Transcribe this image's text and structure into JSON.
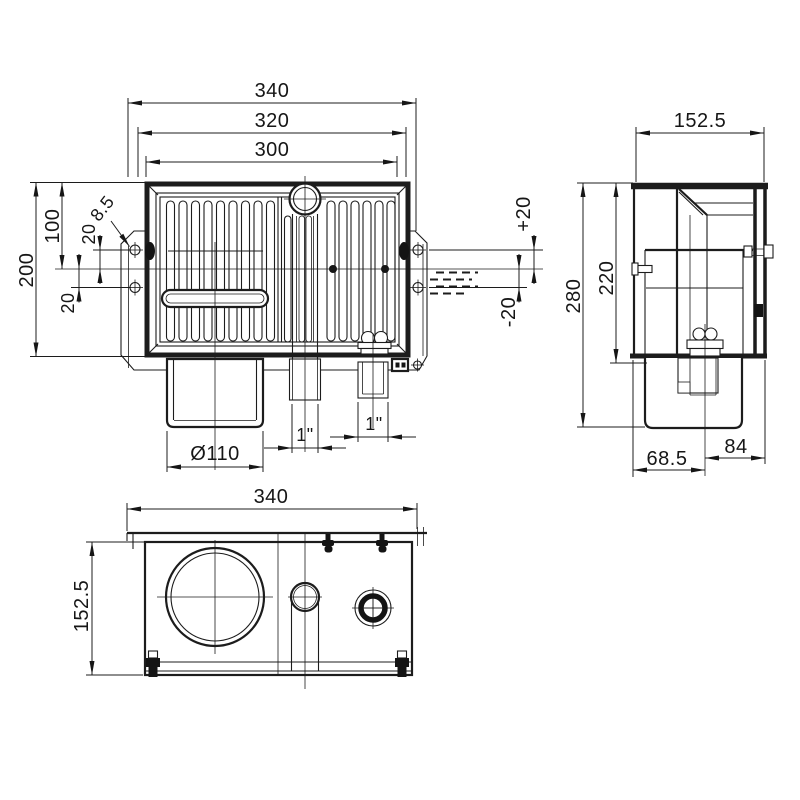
{
  "page": {
    "background": "#ffffff",
    "line_color": "#1c1c1c"
  },
  "drawing": {
    "kind": "technical-dimensional-drawing",
    "views": [
      {
        "id": "front",
        "name": "front view"
      },
      {
        "id": "side",
        "name": "side view"
      },
      {
        "id": "bottom",
        "name": "bottom view"
      }
    ],
    "dimensions": {
      "front": {
        "overall_width": "340",
        "frame_width": "320",
        "opening_width": "300",
        "overall_height": "200",
        "upper_height": "100",
        "offset_upper": "20",
        "offset_lower": "20",
        "hole_dia": "8.5",
        "water_plus": "+20",
        "water_minus": "-20",
        "drain_dia": "Ø110",
        "port_mid": "1\"",
        "port_right": "1\""
      },
      "side": {
        "depth": "152.5",
        "overall_height": "280",
        "body_height": "220",
        "pipe_offset_left": "68.5",
        "pipe_offset_right": "84"
      },
      "bottom": {
        "overall_width": "340",
        "overall_depth": "152.5"
      }
    }
  }
}
